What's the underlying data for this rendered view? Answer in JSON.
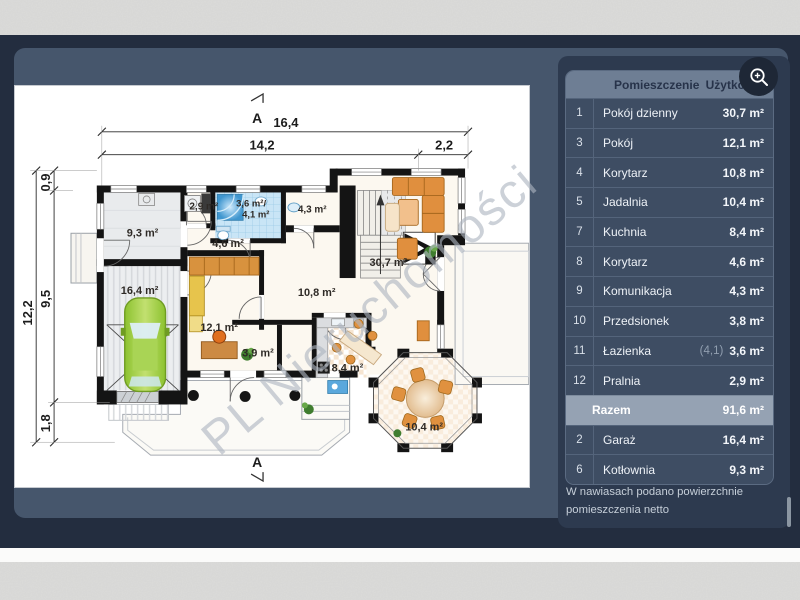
{
  "watermark": {
    "text": "PL Nieruchomości"
  },
  "floor_plan": {
    "section_label": "A",
    "dims": {
      "top_total": "16,4",
      "top_main": "14,2",
      "top_side": "2,2",
      "left_total": "12,2",
      "left_top": "0,9",
      "left_main": "9,5",
      "left_bottom": "1,8"
    },
    "areas": {
      "kotlownia": "9,3 m²",
      "pralnia": "2,9 m²",
      "lazienka_net": "3,6 m²/",
      "lazienka_gross": "4,1 m²",
      "wc": "4,3 m²",
      "korytarz": "4,6 m²",
      "garaz": "16,4 m²",
      "pokoj": "12,1 m²",
      "hol": "10,8 m²",
      "komunikacja": "3,9 m²",
      "pokoj_dzienny": "30,7 m²",
      "kuchnia": "8,4 m²",
      "jadalnia": "10,4 m²"
    }
  },
  "panel": {
    "header": {
      "room_col": "Pomieszczenie",
      "area_col": "Użytkowa"
    },
    "rows": [
      {
        "no": "1",
        "name": "Pokój dzienny",
        "net": "",
        "area": "30,7 m²"
      },
      {
        "no": "3",
        "name": "Pokój",
        "net": "",
        "area": "12,1 m²"
      },
      {
        "no": "4",
        "name": "Korytarz",
        "net": "",
        "area": "10,8 m²"
      },
      {
        "no": "5",
        "name": "Jadalnia",
        "net": "",
        "area": "10,4 m²"
      },
      {
        "no": "7",
        "name": "Kuchnia",
        "net": "",
        "area": "8,4 m²"
      },
      {
        "no": "8",
        "name": "Korytarz",
        "net": "",
        "area": "4,6 m²"
      },
      {
        "no": "9",
        "name": "Komunikacja",
        "net": "",
        "area": "4,3 m²"
      },
      {
        "no": "10",
        "name": "Przedsionek",
        "net": "",
        "area": "3,8 m²"
      },
      {
        "no": "11",
        "name": "Łazienka",
        "net": "(4,1)",
        "area": "3,6 m²"
      },
      {
        "no": "12",
        "name": "Pralnia",
        "net": "",
        "area": "2,9 m²"
      }
    ],
    "total": {
      "label": "Razem",
      "area": "91,6 m²"
    },
    "extra_rows": [
      {
        "no": "2",
        "name": "Garaż",
        "net": "",
        "area": "16,4 m²"
      },
      {
        "no": "6",
        "name": "Kotłownia",
        "net": "",
        "area": "9,3 m²"
      }
    ],
    "note": "W nawiasach podano powierzchnie pomieszczenia netto"
  }
}
